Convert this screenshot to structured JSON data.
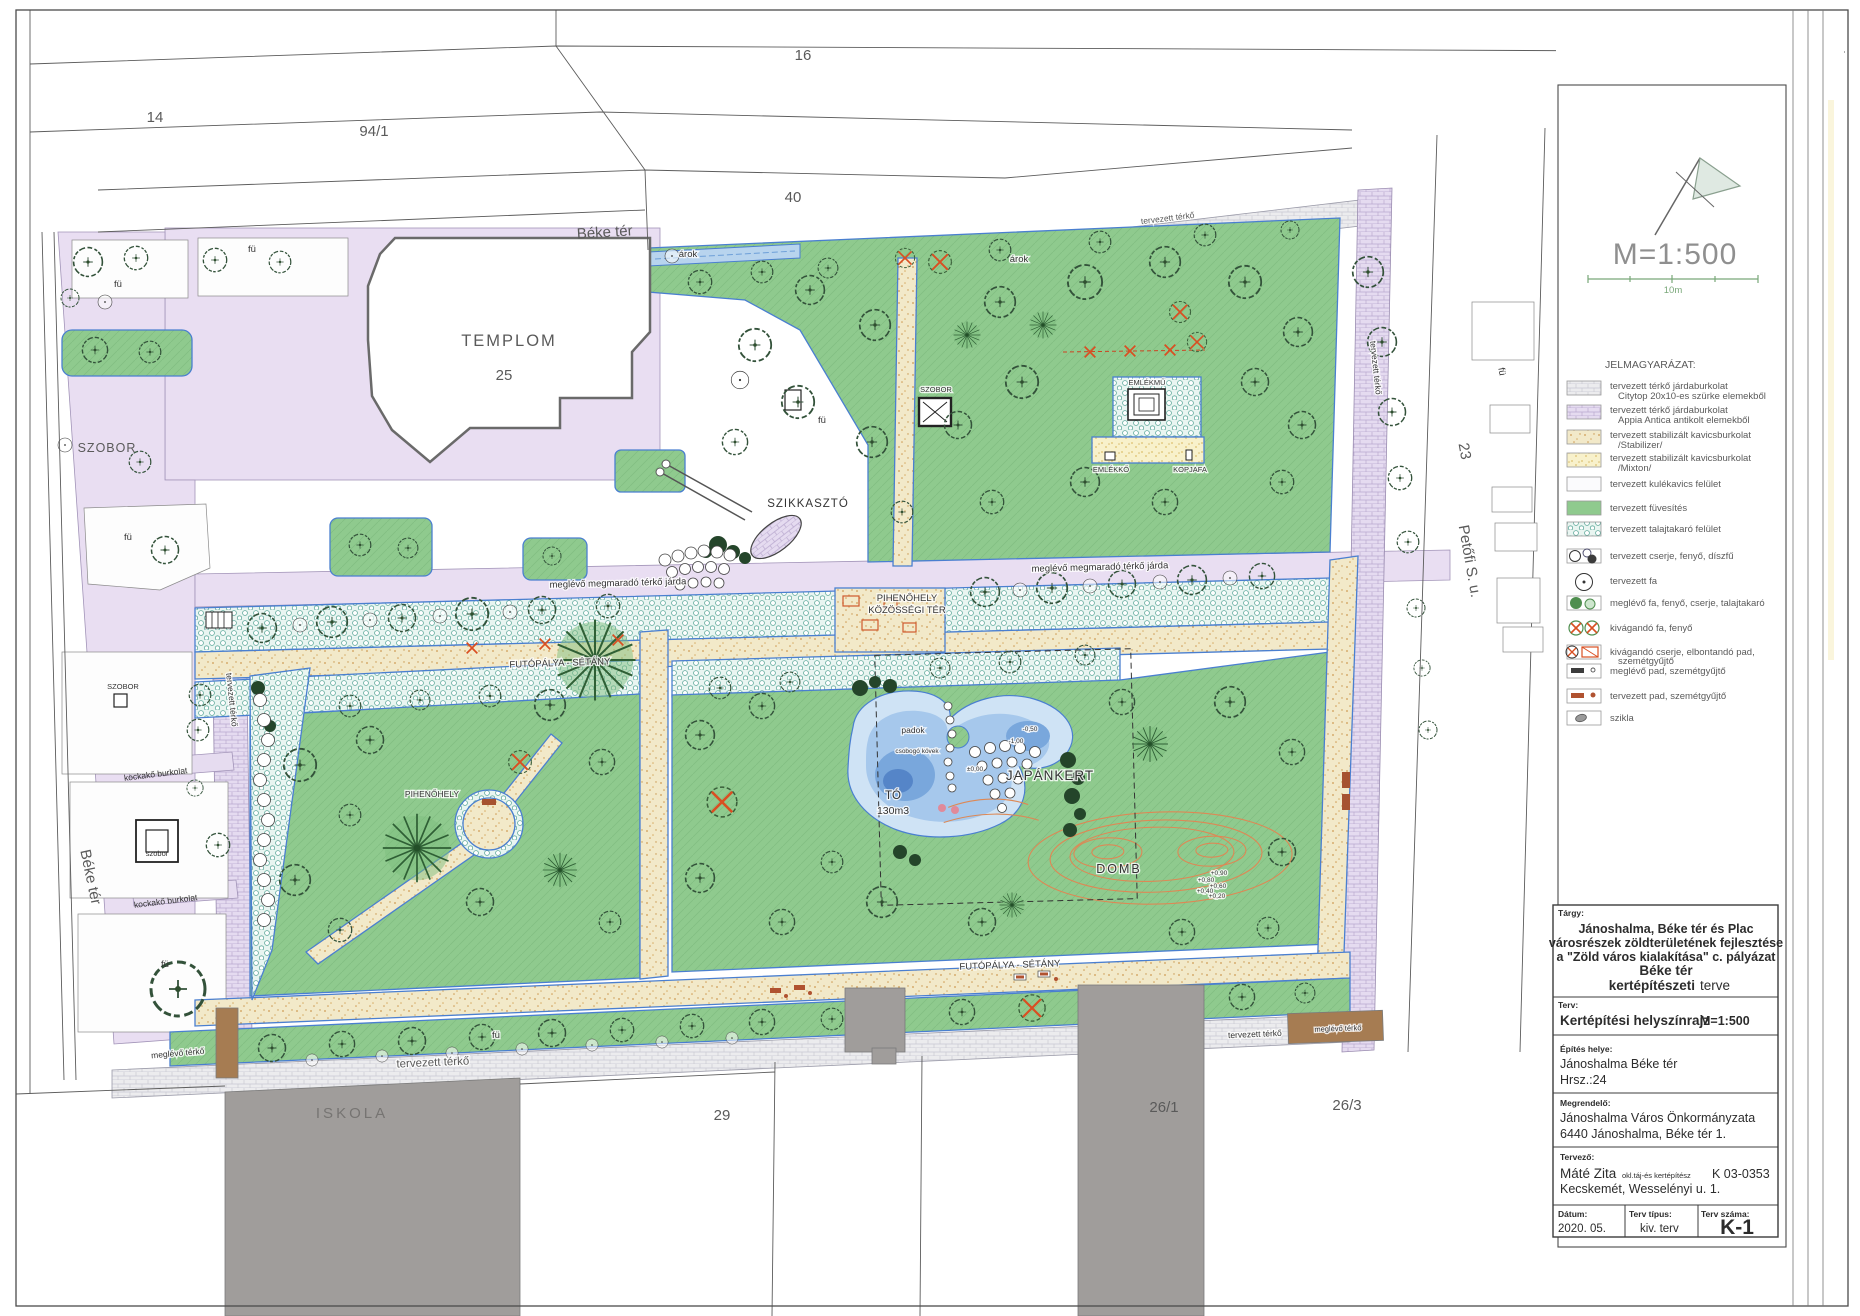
{
  "plan": {
    "parcels": {
      "n14": "14",
      "n94_1": "94/1",
      "n16": "16",
      "n40": "40",
      "n25": "25",
      "n23": "23",
      "n29": "29",
      "n26_1": "26/1",
      "n26_3": "26/3"
    },
    "streets": {
      "beke_ter": "Béke tér",
      "petofi": "Petőfi S. u."
    },
    "labels": {
      "templom": "TEMPLOM",
      "szobor_caps": "SZOBOR",
      "szobor_small": "szobor",
      "fu": "fü",
      "arok": "árok",
      "szikkaszto": "SZIKKASZTÓ",
      "emlekmu": "EMLÉKMŰ",
      "emlekko": "EMLÉKKŐ",
      "kopjafa": "KOPJAFA",
      "walkway": "meglévő megmaradó térkő járda",
      "pihenohely": "PIHENŐHELY",
      "kozossegi_ter": "KÖZÖSSÉGI TÉR",
      "futopalya": "FUTÓPÁLYA - SÉTÁNY",
      "padok": "padok",
      "to": "TÓ",
      "to_volume": "130m3",
      "japankert": "JAPÁNKERT",
      "domb": "DOMB",
      "csobogo_kovek": "csobogó kövek",
      "kockako_burkolat": "kockakő burkolat",
      "iskola": "ISKOLA",
      "tervezett_terko": "tervezett térkő",
      "meglevo_terko": "meglévő térkő",
      "lvl_zero": "±0,00",
      "lvl_m050": "-0,50",
      "lvl_m100": "-1,00",
      "lvl_p090": "+0,90",
      "lvl_p080": "+0,80",
      "lvl_p060": "+0,60",
      "lvl_p040": "+0,40",
      "lvl_p020": "+0,20"
    }
  },
  "panel": {
    "scale": "M=1:500",
    "scalebar_label": "10m",
    "legend_title": "JELMAGYARÁZAT:",
    "legend": [
      {
        "line1": "tervezett térkő járdaburkolat",
        "line2": "Citytop 20x10-es szürke elemekből"
      },
      {
        "line1": "tervezett térkő járdaburkolat",
        "line2": "Appia Antica antikolt elemekből"
      },
      {
        "line1": "tervezett stabilizált kavicsburkolat",
        "line2": "/Stabilizer/"
      },
      {
        "line1": "tervezett stabilizált kavicsburkolat",
        "line2": "/Mixton/"
      },
      {
        "line1": "tervezett kulékavics felület",
        "line2": ""
      },
      {
        "line1": "tervezett füvesítés",
        "line2": ""
      },
      {
        "line1": "tervezett talajtakaró felület",
        "line2": ""
      },
      {
        "line1": "tervezett cserje, fenyő, díszfű",
        "line2": ""
      },
      {
        "line1": "tervezett fa",
        "line2": ""
      },
      {
        "line1": "meglévő fa, fenyő, cserje, talajtakaró",
        "line2": ""
      },
      {
        "line1": "kivágandó fa, fenyő",
        "line2": ""
      },
      {
        "line1": "kivágandó cserje, elbontandó pad,",
        "line2": "szemétgyűjtő"
      },
      {
        "line1": "meglévő pad, szemétgyűjtő",
        "line2": ""
      },
      {
        "line1": "tervezett pad, szemétgyűjtő",
        "line2": ""
      },
      {
        "line1": "szikla",
        "line2": ""
      }
    ],
    "title_block": {
      "targy_label": "Tárgy:",
      "targy_line1": "Jánoshalma, Béke tér és Plac",
      "targy_line2": "városrészek zöldterületének fejlesztése",
      "targy_line3": "a \"Zöld város kialakítása\" c. pályázat",
      "targy_line4": "Béke tér",
      "targy_line5_b": "kertépítészeti",
      "targy_line5_r": "terve",
      "terv_label": "Terv:",
      "terv_value": "Kertépítési helyszínrajz",
      "terv_scale": "M=1:500",
      "epites_label": "Építés helye:",
      "epites_line1": "Jánoshalma Béke tér",
      "epites_line2": "Hrsz.:24",
      "megrendelo_label": "Megrendelő:",
      "megrendelo_line1": "Jánoshalma Város Önkormányzata",
      "megrendelo_line2": "6440 Jánoshalma, Béke tér 1.",
      "tervezo_label": "Tervező:",
      "tervezo_name": "Máté Zita",
      "tervezo_title": "okl.táj-és kertépítész",
      "tervezo_reg": "K 03-0353",
      "tervezo_line2": "Kecskemét, Wesselényi u. 1.",
      "datum_label": "Dátum:",
      "datum_value": "2020. 05.",
      "tipus_label": "Terv típus:",
      "tipus_value": "kiv. terv",
      "szama_label": "Terv száma:",
      "szama_value": "K-1"
    }
  },
  "colors": {
    "grass": "#8fca8e",
    "path_tan": "#f2e9c9",
    "groundcover": "#e9f5f1",
    "paving_lavender": "#e9def2",
    "pond_blue": "#79a7dc",
    "contour_orange": "#dd8855",
    "remove_red": "#d94f22",
    "edge_blue": "#4a7fd0"
  }
}
